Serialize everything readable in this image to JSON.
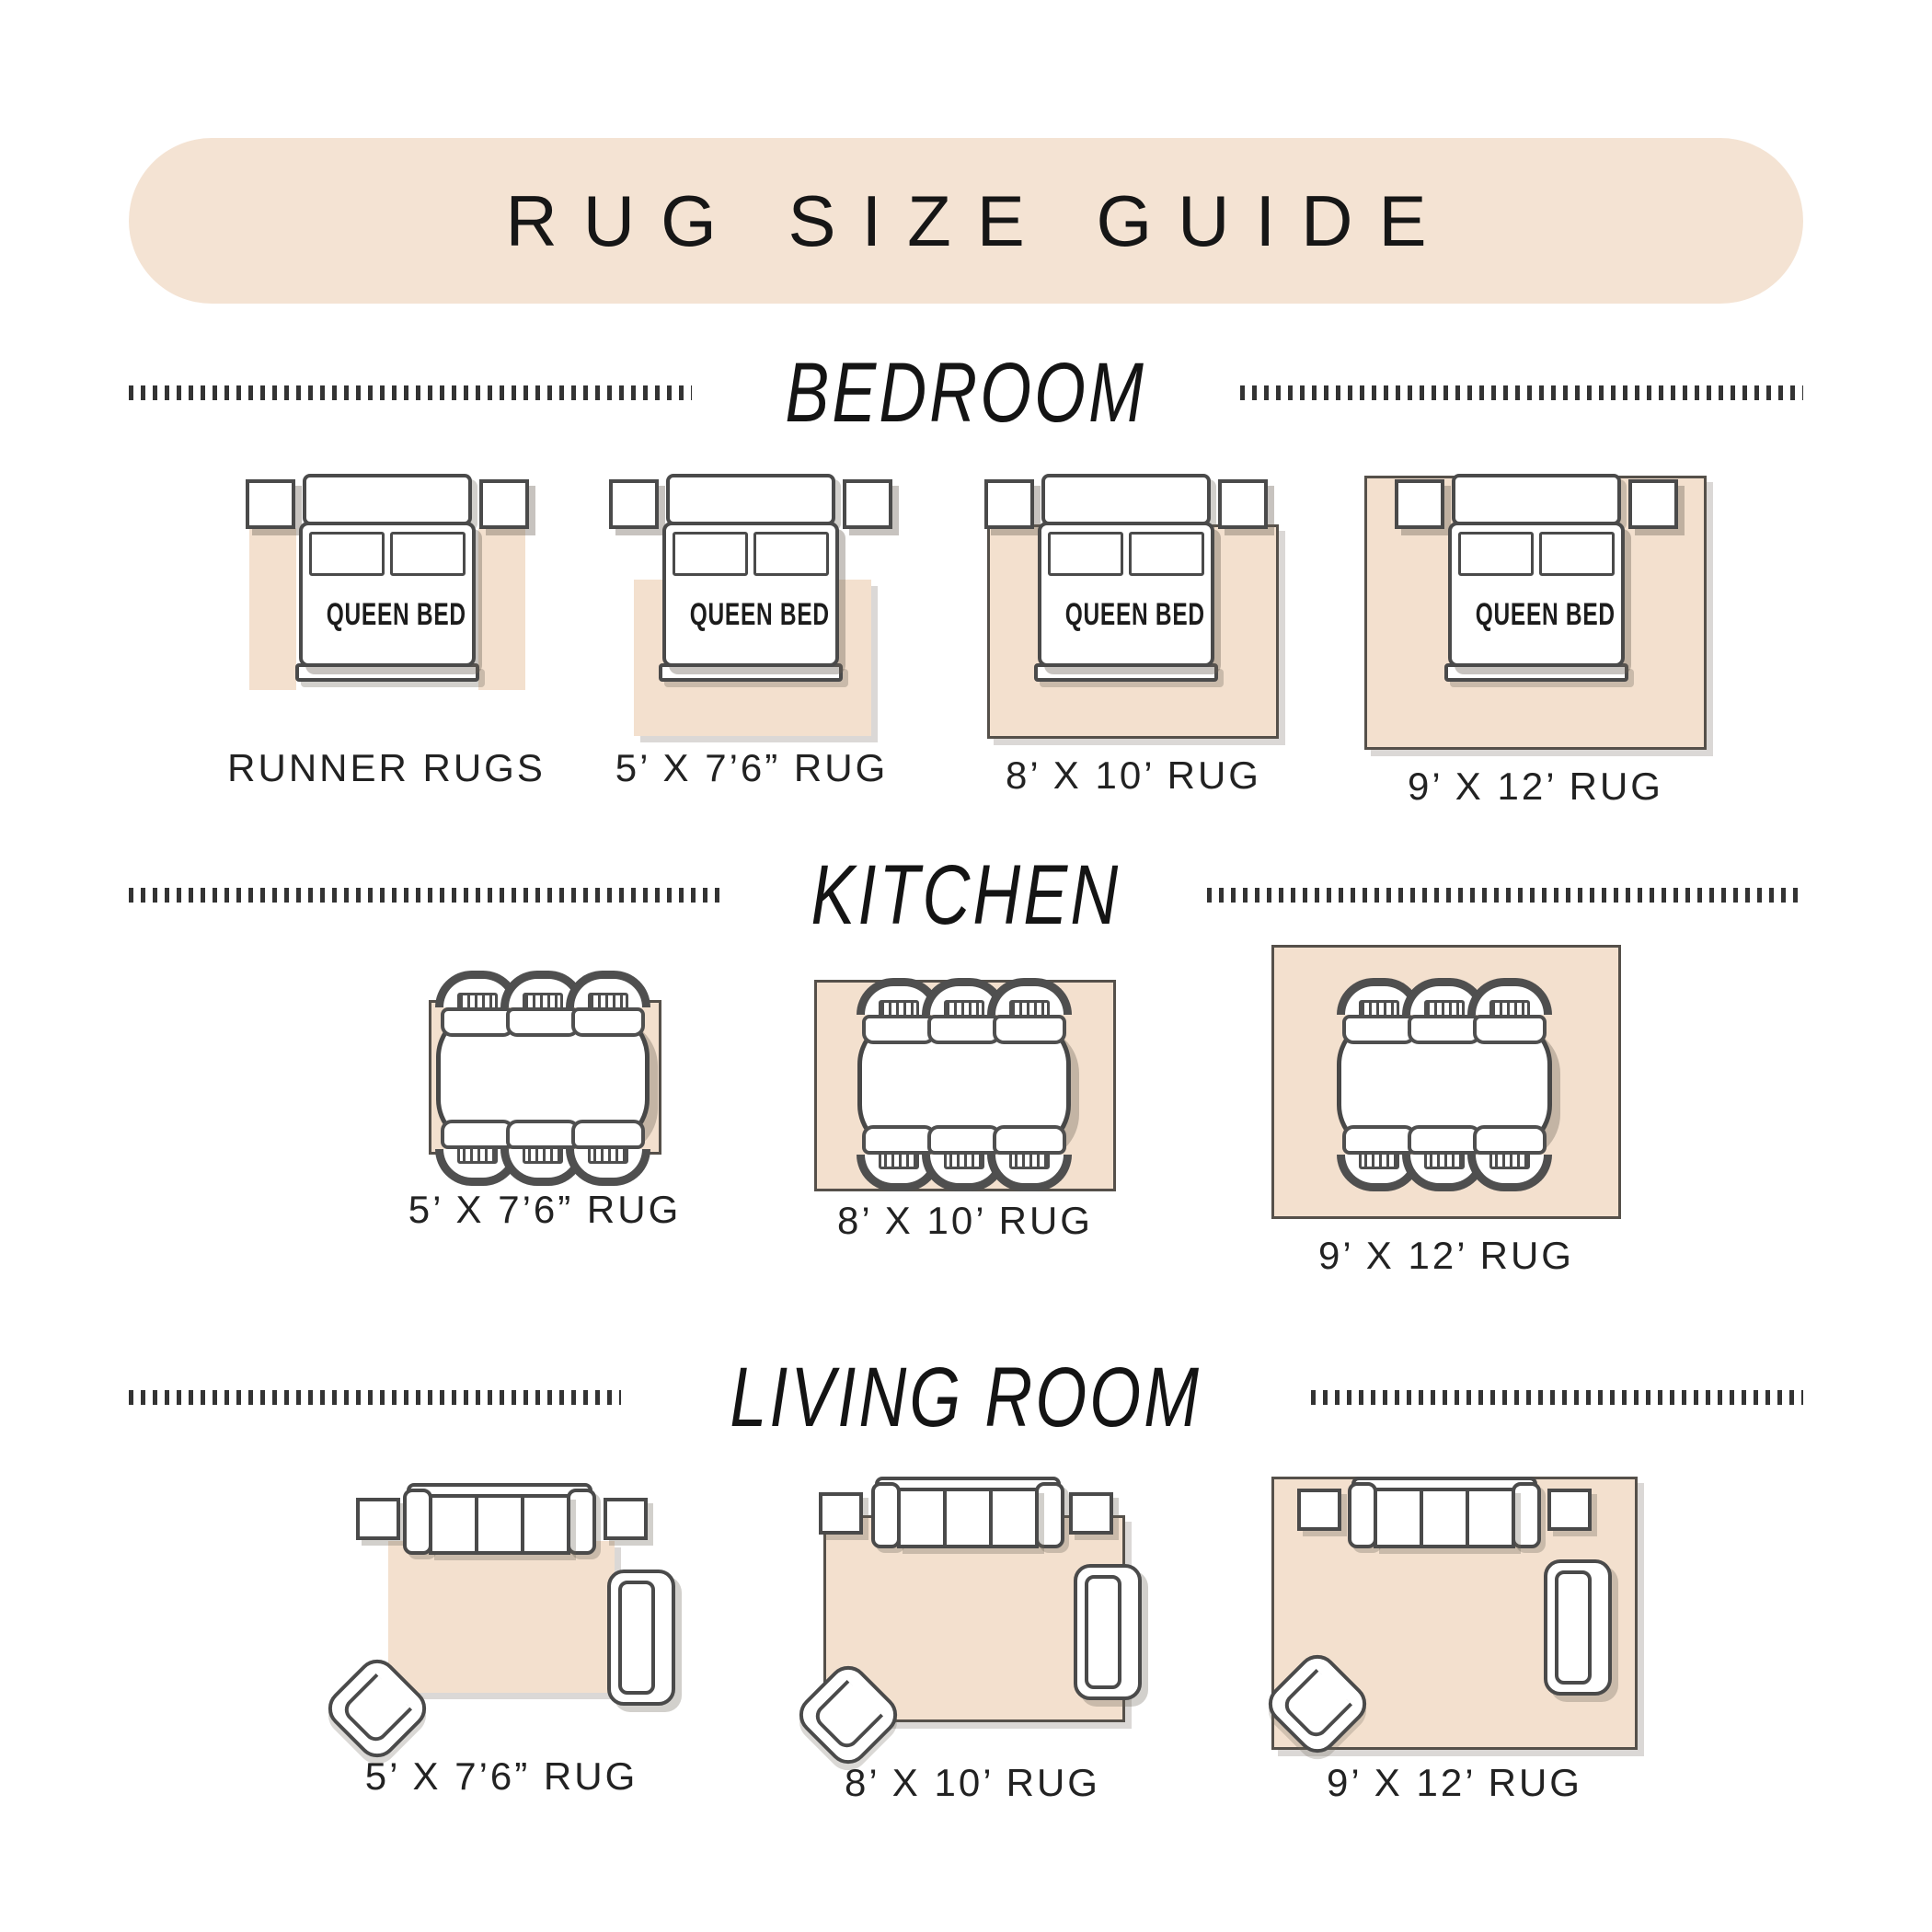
{
  "title": "RUG SIZE GUIDE",
  "colors": {
    "banner": "#f4e3d3",
    "rug": "#f3e0ce",
    "outline": "#4a4a4a",
    "text": "#1c1c1c"
  },
  "sections": {
    "bedroom": {
      "label": "BEDROOM",
      "bed_label": "QUEEN BED",
      "items": [
        {
          "label": "RUNNER RUGS"
        },
        {
          "label": "5’ X 7’6” RUG"
        },
        {
          "label": "8’ X 10’ RUG"
        },
        {
          "label": "9’ X 12’ RUG"
        }
      ]
    },
    "kitchen": {
      "label": "KITCHEN",
      "items": [
        {
          "label": "5’ X 7’6” RUG"
        },
        {
          "label": "8’ X 10’ RUG"
        },
        {
          "label": "9’ X 12’ RUG"
        }
      ]
    },
    "living_room": {
      "label": "LIVING ROOM",
      "items": [
        {
          "label": "5’ X 7’6” RUG"
        },
        {
          "label": "8’ X 10’ RUG"
        },
        {
          "label": "9’ X 12’ RUG"
        }
      ]
    }
  }
}
